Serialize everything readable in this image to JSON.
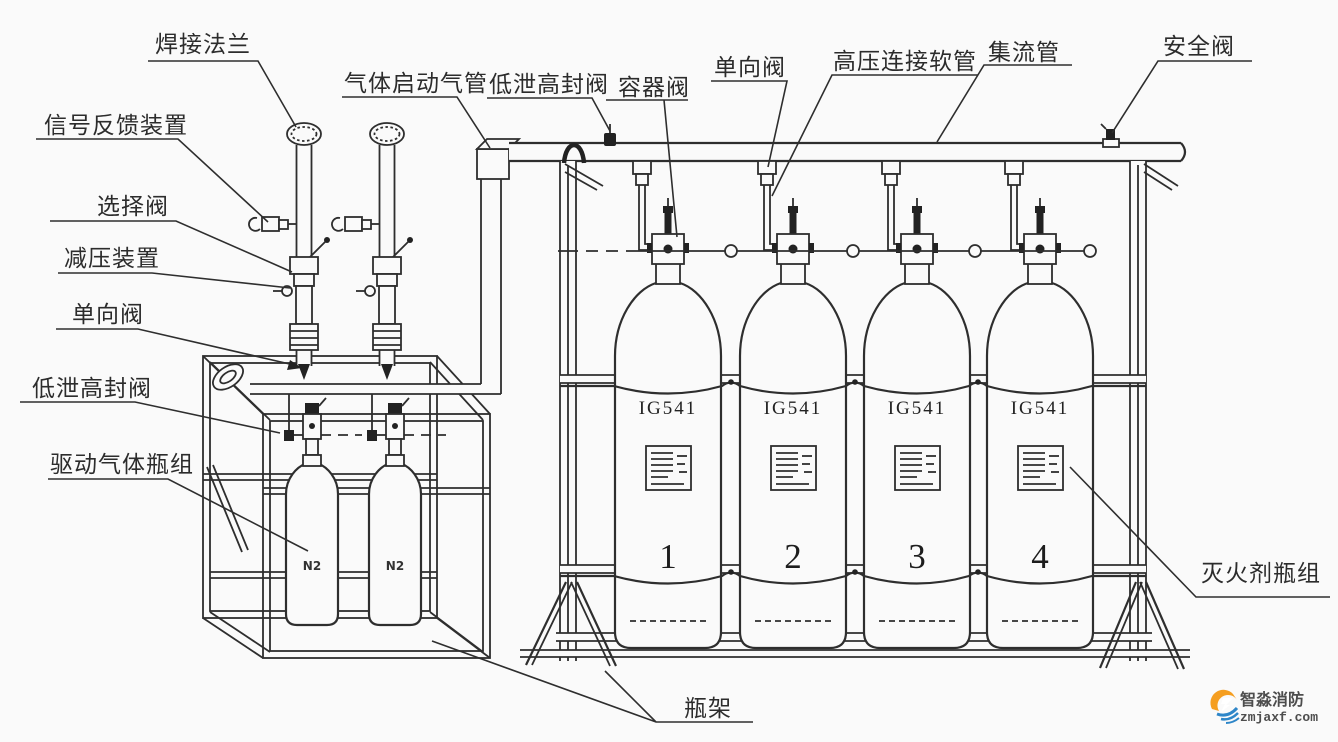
{
  "labels": {
    "welding_flange": "焊接法兰",
    "signal_feedback": "信号反馈装置",
    "selector_valve": "选择阀",
    "pressure_reducer": "减压装置",
    "check_valve_left": "单向阀",
    "low_leak_valve_left": "低泄高封阀",
    "driver_gas_group": "驱动气体瓶组",
    "gas_startup_pipe": "气体启动气管",
    "low_leak_valve_top": "低泄高封阀",
    "container_valve": "容器阀",
    "check_valve_top": "单向阀",
    "hp_hose": "高压连接软管",
    "manifold": "集流管",
    "safety_valve": "安全阀",
    "agent_group": "灭火剂瓶组",
    "rack": "瓶架"
  },
  "cylinders": [
    {
      "gas": "IG541",
      "number": "1"
    },
    {
      "gas": "IG541",
      "number": "2"
    },
    {
      "gas": "IG541",
      "number": "3"
    },
    {
      "gas": "IG541",
      "number": "4"
    }
  ],
  "driver_cylinders": [
    {
      "label": "N2"
    },
    {
      "label": "N2"
    }
  ],
  "watermark": {
    "brand": "智淼消防",
    "url": "zmjaxf.com"
  },
  "colors": {
    "line": "#2e2e2e",
    "background": "#fafafa",
    "wm_orange": "#f59e20",
    "wm_blue": "#2e86c8"
  }
}
